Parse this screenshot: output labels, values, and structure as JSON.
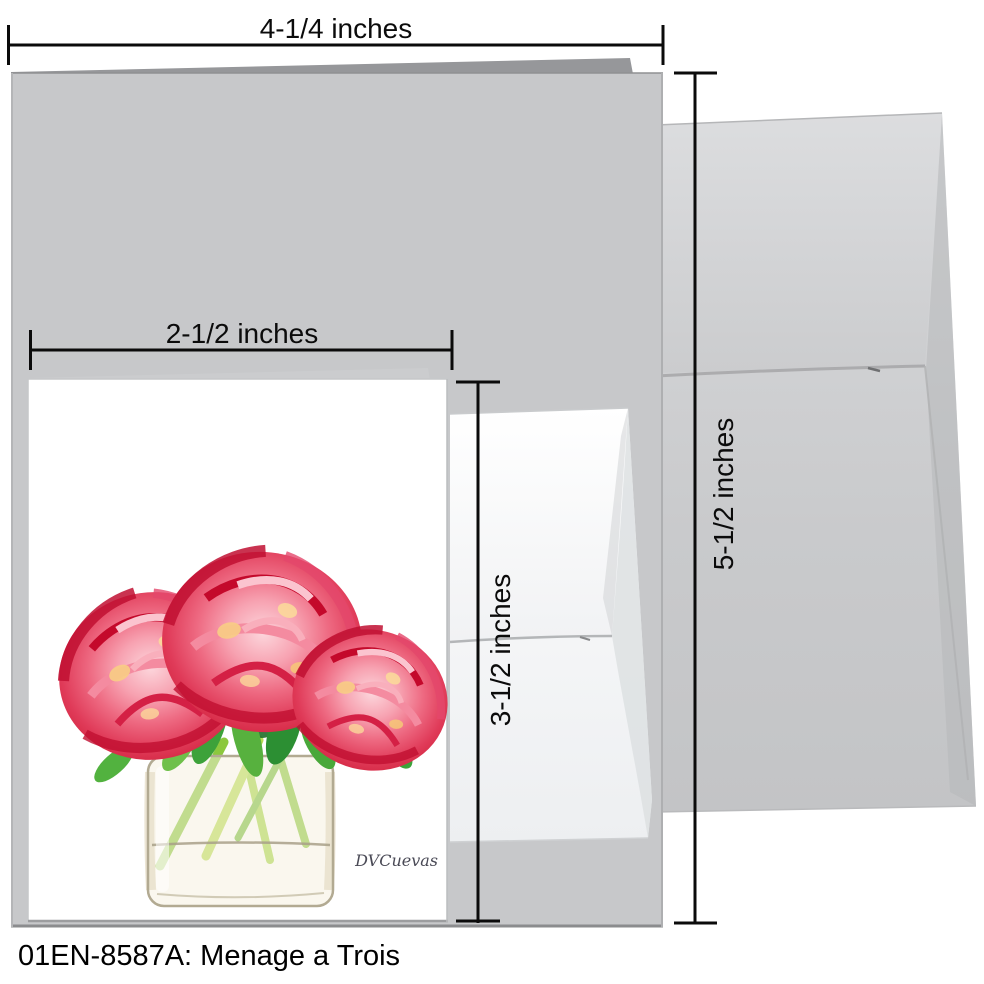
{
  "caption": "01EN-8587A: Menage a Trois",
  "artwork": {
    "signature": "DVCuevas",
    "subject": "three pink peonies in a square glass vase"
  },
  "dimensions": {
    "folded_card_width": "4-1/4 inches",
    "insert_card_width": "2-1/2 inches",
    "insert_card_height": "3-1/2 inches",
    "folded_card_height": "5-1/2 inches"
  },
  "colors": {
    "background": "#ffffff",
    "folded_card_gray": "#c7c8ca",
    "folded_card_back_edge": "#96979a",
    "large_envelope_gray": "#d2d3d5",
    "small_envelope_white": "#f7f8f9",
    "insert_card_white": "#ffffff",
    "dimension_line_black": "#0b0b0b",
    "peony_deep_red": "#d2243f",
    "peony_pink": "#ee6a82",
    "peony_light_pink": "#fcd6dc",
    "peony_accent_yellow": "#f6c877",
    "leaf_green": "#3da23a",
    "stem_green": "#8cc83e",
    "vase_cream": "#f5efde"
  }
}
